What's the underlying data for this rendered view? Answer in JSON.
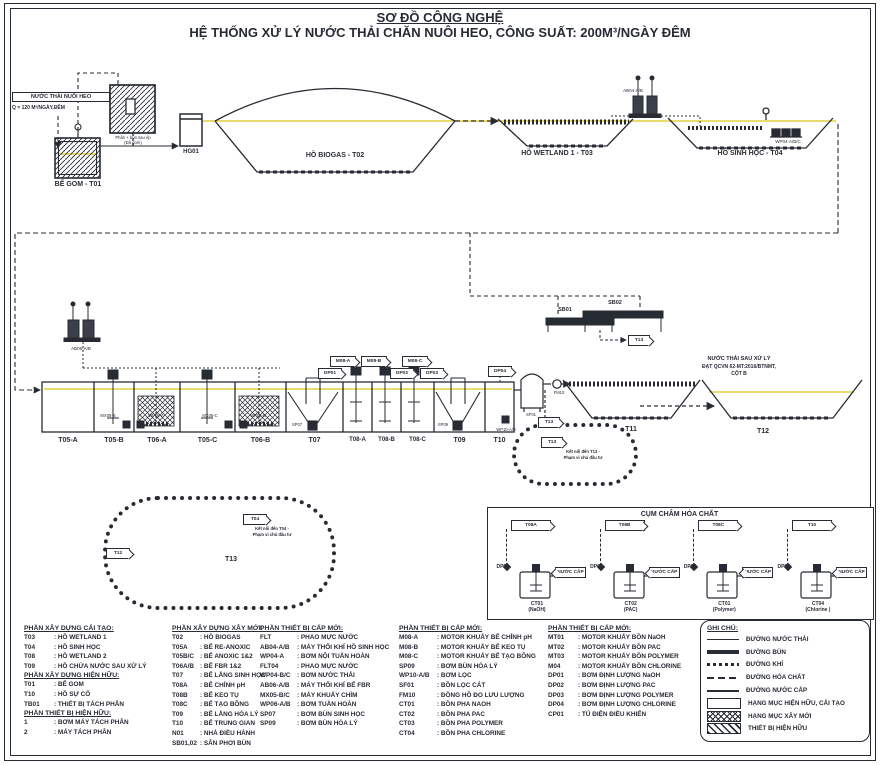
{
  "title": {
    "line1": "SƠ ĐỒ CÔNG NGHỆ",
    "line2": "HỆ THỐNG XỬ LÝ NƯỚC THẢI CHĂN NUÔI HEO, CÔNG SUẤT: 200M³/NGÀY ĐÊM"
  },
  "top": {
    "influent1": "NƯỚC THẢI NUÔI HEO",
    "influent2": "Q = 120 M³/NGÀY.ĐÊM",
    "be_gom": "BỂ GOM - T01",
    "sep1": "Phân + bùn sau ép",
    "sep2": "(Đã gom)",
    "hg01": "HG01",
    "biogas": "HỒ BIOGAS - T02",
    "wetland1": "HỒ WETLAND 1 - T03",
    "ab04": "AB04-A/B",
    "sinh_hoc": "HỒ SINH HỌC - T04",
    "wp04": "WP04-A/B/C"
  },
  "mid": {
    "ab06": "AB06-A/B",
    "tanks": [
      "T05-A",
      "T05-B",
      "T06-A",
      "T05-C",
      "T06-B",
      "T07",
      "T08-A",
      "T08-B",
      "T08-C",
      "T09",
      "T10"
    ],
    "m08a": "M08-A",
    "dp01": "DP01",
    "m08b": "M08-B",
    "dp02": "DP02",
    "m08c": "M08-C",
    "dp03": "DP03",
    "dp04": "DP04",
    "mx05b": "MX05-B",
    "wp06a": "WP06-A",
    "mx05c": "MX05-C",
    "wp06b": "WP06-B",
    "sp07": "SP07",
    "sp09": "SP09",
    "sb01": "SB01",
    "sb02": "SB02",
    "sb_flag": "T13",
    "sf01": "SF01",
    "wp10": "WP10-A/B",
    "fm10": "FM10",
    "t11": "T11",
    "t12": "T12",
    "eff1": "NƯỚC THẢI SAU XỬ LÝ",
    "eff2": "ĐẠT QCVN 62-MT:2016/BTNMT,",
    "eff3": "CỘT B",
    "sc_flag1": "T13",
    "sc_flag2": "T13",
    "sc_note1": "Kết nối đến T13 -",
    "sc_note2": "Phạm vi chủ đầu tư"
  },
  "cloud13": {
    "in_flag": "T12",
    "t13": "T13",
    "out_flag": "T04",
    "note1": "Kết nối đến T04 -",
    "note2": "Phạm vi chủ đầu tư"
  },
  "chem": {
    "title": "CỤM CHÂM HÓA CHẤT",
    "stations": [
      {
        "target": "T08A",
        "pump": "DP01",
        "water": "NƯỚC CẤP",
        "code": "CT01",
        "name": "(NaOH)"
      },
      {
        "target": "T08B",
        "pump": "DP02",
        "water": "NƯỚC CẤP",
        "code": "CT02",
        "name": "(PAC)"
      },
      {
        "target": "T08C",
        "pump": "DP03",
        "water": "NƯỚC CẤP",
        "code": "CT01",
        "name": "(Polymer)"
      },
      {
        "target": "T10",
        "pump": "DP04",
        "water": "NƯỚC CẤP",
        "code": "CT04",
        "name": "(Chlorine )"
      }
    ]
  },
  "legend": {
    "col1": {
      "h1": "PHẦN XÂY DỰNG CẢI TẠO:",
      "s1": [
        {
          "code": "T03",
          "desc": ": HỒ WETLAND 1"
        },
        {
          "code": "T04",
          "desc": ": HỒ SINH HỌC"
        },
        {
          "code": "T08",
          "desc": ": HỒ WETLAND 2"
        },
        {
          "code": "T09",
          "desc": ": HỒ CHỨA NƯỚC SAU XỬ LÝ"
        }
      ],
      "h2": "PHẦN XÂY DỰNG HIỆN HỮU:",
      "s2": [
        {
          "code": "T01",
          "desc": ": BỂ GOM"
        },
        {
          "code": "T10",
          "desc": ": HỒ SỰ CỐ"
        },
        {
          "code": "TB01",
          "desc": ": THIẾT BỊ TÁCH PHÂN"
        }
      ],
      "h3": "PHẦN THIẾT BỊ HIỆN HỮU:",
      "s3": [
        {
          "code": "1",
          "desc": ": BƠM MÁY TÁCH PHÂN"
        },
        {
          "code": "2",
          "desc": ": MÁY TÁCH PHÂN"
        }
      ]
    },
    "col2": {
      "h": "PHẦN XÂY DỰNG XÂY MỚI:",
      "rows": [
        {
          "code": "T02",
          "desc": ": HỒ BIOGAS"
        },
        {
          "code": "T05A",
          "desc": ": BỂ RE-ANOXIC"
        },
        {
          "code": "T05B/C",
          "desc": ": BỂ ANOXIC 1&2"
        },
        {
          "code": "T06A/B",
          "desc": ": BỂ FBR 1&2"
        },
        {
          "code": "T07",
          "desc": ": BỂ LẮNG SINH HỌC"
        },
        {
          "code": "T08A",
          "desc": ": BỂ CHỈNH pH"
        },
        {
          "code": "T08B",
          "desc": ": BỂ KEO TỤ"
        },
        {
          "code": "T08C",
          "desc": ": BỂ TẠO BÔNG"
        },
        {
          "code": "T09",
          "desc": ": BỂ LẮNG HÓA LÝ"
        },
        {
          "code": "T10",
          "desc": ": BỂ TRUNG GIAN"
        },
        {
          "code": "N01",
          "desc": ": NHÀ ĐIỀU HÀNH"
        },
        {
          "code": "SB01,02",
          "desc": ": SÂN PHƠI BÙN"
        }
      ]
    },
    "col3": {
      "h": "PHẦN THIẾT BỊ CẤP MỚI:",
      "rows": [
        {
          "code": "FLT",
          "desc": ": PHAO MỰC NƯỚC"
        },
        {
          "code": "AB04-A/B",
          "desc": ": MÁY THỔI KHÍ HỒ SINH HỌC"
        },
        {
          "code": "WP04-A",
          "desc": ": BƠM NỘI TUẦN HOÀN"
        },
        {
          "code": "FLT04",
          "desc": ": PHAO MỰC NƯỚC"
        },
        {
          "code": "WP04-B/C",
          "desc": ": BƠM NƯỚC THẢI"
        },
        {
          "code": "AB06-A/B",
          "desc": ": MÁY THỔI KHÍ BỂ FBR"
        },
        {
          "code": "MX05-B/C",
          "desc": ": MÁY KHUẤY CHÌM"
        },
        {
          "code": "WP06-A/B",
          "desc": ": BƠM TUẦN HOÀN"
        },
        {
          "code": "SP07",
          "desc": ": BƠM BÙN SINH HỌC"
        },
        {
          "code": "SP09",
          "desc": ": BƠM BÙN HÓA LÝ"
        }
      ]
    },
    "col4": {
      "h": "PHẦN THIẾT BỊ CẤP MỚI:",
      "rows": [
        {
          "code": "M08-A",
          "desc": ": MOTOR KHUẤY BỂ CHỈNH pH"
        },
        {
          "code": "M08-B",
          "desc": ": MOTOR KHUẤY BỂ KEO TỤ"
        },
        {
          "code": "M08-C",
          "desc": ": MOTOR KHUẤY BỂ TẠO BÔNG"
        },
        {
          "code": "SP09",
          "desc": ": BƠM BÙN HÓA LÝ"
        },
        {
          "code": "WP10-A/B",
          "desc": ": BƠM LỌC"
        },
        {
          "code": "SF01",
          "desc": ": BỒN LỌC CÁT"
        },
        {
          "code": "FM10",
          "desc": ": ĐỒNG HỒ ĐO LƯU LƯỢNG"
        },
        {
          "code": "CT01",
          "desc": ": BỒN PHA NAOH"
        },
        {
          "code": "CT02",
          "desc": ": BỒN PHA PAC"
        },
        {
          "code": "CT03",
          "desc": ": BỒN PHA POLYMER"
        },
        {
          "code": "CT04",
          "desc": ": BỒN PHA CHLORINE"
        }
      ]
    },
    "col5": {
      "h": "PHẦN THIẾT BỊ CẤP MỚI:",
      "rows": [
        {
          "code": "MT01",
          "desc": ": MOTOR KHUẤY BỒN NaOH"
        },
        {
          "code": "MT02",
          "desc": ": MOTOR KHUẤY BỒN PAC"
        },
        {
          "code": "MT03",
          "desc": ": MOTOR KHUẤY BỒN POLYMER"
        },
        {
          "code": "M04",
          "desc": ": MOTOR KHUẤY BỒN CHLORINE"
        },
        {
          "code": "DP01",
          "desc": ": BƠM ĐỊNH LƯỢNG NaOH"
        },
        {
          "code": "DP02",
          "desc": ": BƠM ĐỊNH LƯỢNG PAC"
        },
        {
          "code": "DP03",
          "desc": ": BƠM ĐỊNH LƯỢNG POLYMER"
        },
        {
          "code": "DP04",
          "desc": ": BƠM ĐỊNH LƯỢNG CHLORINE"
        },
        {
          "code": "CP01",
          "desc": ": TỦ ĐIỆN ĐIỀU KHIỂN"
        }
      ]
    }
  },
  "notes": {
    "h": "GHI CHÚ:",
    "items": [
      {
        "label": "ĐƯỜNG NƯỚC THẢI",
        "type": "sw-thin"
      },
      {
        "label": "ĐƯỜNG BÙN",
        "type": "sw-thick"
      },
      {
        "label": "ĐƯỜNG KHÍ",
        "type": "sw-dot"
      },
      {
        "label": "ĐƯỜNG HÓA CHẤT",
        "type": "sw-dash"
      },
      {
        "label": "ĐƯỜNG NƯỚC CẤP",
        "type": "sw-med"
      },
      {
        "label": "HẠNG MỤC HIỆN HỮU, CẢI TẠO",
        "type": "sw-box"
      },
      {
        "label": "HẠNG MỤC XÂY MỚI",
        "type": "sw-cross"
      },
      {
        "label": "THIẾT BỊ HIỆN HỮU",
        "type": "sw-hatch"
      }
    ]
  },
  "colors": {
    "ink": "#272b33",
    "water": "#e3cf3d"
  }
}
